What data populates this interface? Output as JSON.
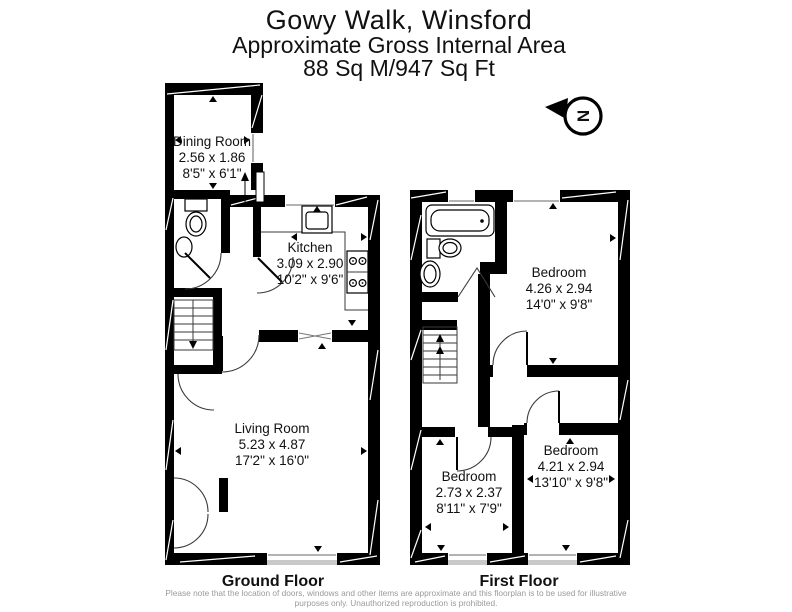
{
  "header": {
    "title": "Gowy Walk, Winsford",
    "subtitle": "Approximate Gross Internal Area",
    "area": "88 Sq M/947 Sq Ft"
  },
  "compass": {
    "letter": "N"
  },
  "floors": [
    {
      "label": "Ground Floor",
      "rooms": [
        {
          "name": "Dining Room",
          "metric": "2.56 x 1.86",
          "imperial": "8'5\" x 6'1\""
        },
        {
          "name": "Kitchen",
          "metric": "3.09 x 2.90",
          "imperial": "10'2\" x 9'6\""
        },
        {
          "name": "Living Room",
          "metric": "5.23 x 4.87",
          "imperial": "17'2\" x 16'0\""
        }
      ]
    },
    {
      "label": "First Floor",
      "rooms": [
        {
          "name": "Bedroom",
          "metric": "4.26 x 2.94",
          "imperial": "14'0\" x 9'8\""
        },
        {
          "name": "Bedroom",
          "metric": "4.21 x 2.94",
          "imperial": "13'10\" x 9'8\""
        },
        {
          "name": "Bedroom",
          "metric": "2.73 x 2.37",
          "imperial": "8'11\" x 7'9\""
        }
      ]
    }
  ],
  "footer": {
    "disclaimer_line1": "Please note that the location of doors, windows and other items are approximate and this floorplan is to be used for illustrative",
    "disclaimer_line2": "purposes only. Unauthorized reproduction is prohibited."
  },
  "colors": {
    "wall": "#000000",
    "window_sill": "#c9c9c9",
    "disclaimer": "#9a9a9a"
  }
}
